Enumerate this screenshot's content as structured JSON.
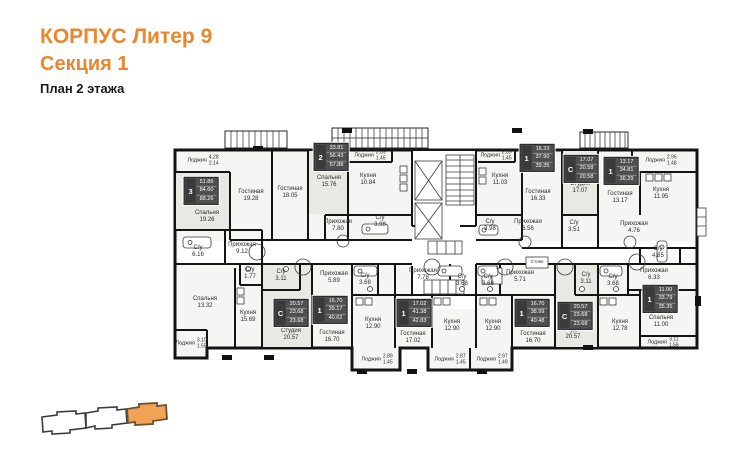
{
  "header": {
    "building": "КОРПУС Литер 9",
    "section": "Секция 1",
    "floor": "План 2 этажа"
  },
  "colors": {
    "accent": "#E8872E",
    "wall": "#141414",
    "keyplan_fill": "#F0A355",
    "keyplan_stroke": "#6B5134",
    "statbox_bg": "#4F4F4F",
    "statbox_type_bg": "#3A3A3A"
  },
  "plan": {
    "rooms": [
      {
        "name": "Лоджия",
        "a1": "4.28",
        "a2": "2.14",
        "x": 203,
        "y": 161
      },
      {
        "name": "Спальня",
        "area": "19.26",
        "x": 207,
        "y": 217
      },
      {
        "name": "Гостиная",
        "area": "19.28",
        "x": 251,
        "y": 196
      },
      {
        "name": "Гостиная",
        "area": "18.05",
        "x": 290,
        "y": 193
      },
      {
        "name": "Спальня",
        "area": "15.76",
        "x": 329,
        "y": 182
      },
      {
        "name": "Прихожая",
        "area": "7.80",
        "x": 338,
        "y": 226
      },
      {
        "name": "Лоджия",
        "a1": "2.89",
        "a2": "1.45",
        "x": 370,
        "y": 156
      },
      {
        "name": "Кухня",
        "area": "10.84",
        "x": 368,
        "y": 180
      },
      {
        "name": "С/у",
        "area": "3.98",
        "x": 380,
        "y": 222
      },
      {
        "name": "Лоджия",
        "a1": "2.89",
        "a2": "1.45",
        "x": 496,
        "y": 156
      },
      {
        "name": "Кухня",
        "area": "11.03",
        "x": 500,
        "y": 180
      },
      {
        "name": "С/у",
        "area": "3.98",
        "x": 490,
        "y": 226
      },
      {
        "name": "Гостиная",
        "area": "16.33",
        "x": 538,
        "y": 196
      },
      {
        "name": "Прихожая",
        "area": "6.56",
        "x": 528,
        "y": 226
      },
      {
        "name": "Студия",
        "area": "17.07",
        "x": 580,
        "y": 188
      },
      {
        "name": "С/у",
        "area": "3.51",
        "x": 574,
        "y": 227
      },
      {
        "name": "Гостиная",
        "area": "13.17",
        "x": 620,
        "y": 198
      },
      {
        "name": "Кухня",
        "area": "11.95",
        "x": 661,
        "y": 194
      },
      {
        "name": "Лоджия",
        "a1": "2.96",
        "a2": "1.48",
        "x": 661,
        "y": 161
      },
      {
        "name": "Прихожая",
        "area": "4.76",
        "x": 634,
        "y": 228
      },
      {
        "name": "С/у",
        "area": "6.16",
        "x": 198,
        "y": 252
      },
      {
        "name": "Прихожая",
        "area": "9.12",
        "x": 242,
        "y": 249
      },
      {
        "name": "С/у",
        "area": "1.77",
        "x": 250,
        "y": 274
      },
      {
        "name": "С/у",
        "area": "3.11",
        "x": 281,
        "y": 276
      },
      {
        "name": "Спальня",
        "area": "13.32",
        "x": 205,
        "y": 303
      },
      {
        "name": "Кухня",
        "area": "15.69",
        "x": 248,
        "y": 317
      },
      {
        "name": "Лоджия",
        "a1": "3.10",
        "a2": "1.55",
        "x": 191,
        "y": 344
      },
      {
        "name": "Студия",
        "area": "20.57",
        "x": 291,
        "y": 335
      },
      {
        "name": "Прихожая",
        "area": "5.89",
        "x": 334,
        "y": 278
      },
      {
        "name": "Гостиная",
        "area": "16.70",
        "x": 332,
        "y": 337
      },
      {
        "name": "С/у",
        "area": "3.68",
        "x": 365,
        "y": 280
      },
      {
        "name": "Кухня",
        "area": "12.90",
        "x": 373,
        "y": 324
      },
      {
        "name": "Прихожая",
        "area": "7.78",
        "x": 423,
        "y": 275
      },
      {
        "name": "Гостиная",
        "area": "17.02",
        "x": 413,
        "y": 338
      },
      {
        "name": "С/у",
        "area": "3.68",
        "x": 462,
        "y": 281
      },
      {
        "name": "Кухня",
        "area": "12.90",
        "x": 452,
        "y": 326
      },
      {
        "name": "С/у",
        "area": "3.68",
        "x": 488,
        "y": 281
      },
      {
        "name": "Кухня",
        "area": "12.90",
        "x": 493,
        "y": 326
      },
      {
        "name": "Прихожая",
        "area": "5.71",
        "x": 520,
        "y": 277
      },
      {
        "name": "Стояк",
        "x": 537,
        "y": 263
      },
      {
        "name": "Гостиная",
        "area": "16.70",
        "x": 533,
        "y": 338
      },
      {
        "name": "С/у",
        "area": "3.11",
        "x": 586,
        "y": 279
      },
      {
        "name": "Студия",
        "area": "20.57",
        "x": 573,
        "y": 334
      },
      {
        "name": "С/у",
        "area": "3.68",
        "x": 613,
        "y": 281
      },
      {
        "name": "Кухня",
        "area": "12.78",
        "x": 620,
        "y": 326
      },
      {
        "name": "С/у",
        "area": "4.85",
        "x": 658,
        "y": 253
      },
      {
        "name": "Прихожая",
        "area": "6.33",
        "x": 654,
        "y": 275
      },
      {
        "name": "Спальня",
        "area": "11.00",
        "x": 661,
        "y": 322
      },
      {
        "name": "Лоджия",
        "a1": "3.11",
        "a2": "1.56",
        "x": 663,
        "y": 343
      },
      {
        "name": "Лоджия",
        "a1": "2.89",
        "a2": "1.45",
        "x": 377,
        "y": 360
      },
      {
        "name": "Лоджия",
        "a1": "2.87",
        "a2": "1.45",
        "x": 450,
        "y": 360
      },
      {
        "name": "Лоджия",
        "a1": "2.97",
        "a2": "1.49",
        "x": 492,
        "y": 360
      }
    ],
    "apartments": [
      {
        "type": "3",
        "values": [
          "51.86",
          "84.60",
          "88.26"
        ],
        "x": 201,
        "y": 191
      },
      {
        "type": "2",
        "values": [
          "33.81",
          "56.43",
          "57.88"
        ],
        "x": 331,
        "y": 157
      },
      {
        "type": "1",
        "values": [
          "16.33",
          "37.90",
          "39.35"
        ],
        "x": 537,
        "y": 158
      },
      {
        "type": "С",
        "values": [
          "17.07",
          "20.58",
          "20.58"
        ],
        "x": 581,
        "y": 169
      },
      {
        "type": "1",
        "values": [
          "13.17",
          "34.81",
          "36.29"
        ],
        "x": 621,
        "y": 171
      },
      {
        "type": "С",
        "values": [
          "20.57",
          "23.68",
          "23.68"
        ],
        "x": 291,
        "y": 313
      },
      {
        "type": "1",
        "values": [
          "16.70",
          "39.17",
          "40.62"
        ],
        "x": 330,
        "y": 310
      },
      {
        "type": "1",
        "values": [
          "17.02",
          "41.38",
          "42.83"
        ],
        "x": 414,
        "y": 313
      },
      {
        "type": "1",
        "values": [
          "16.70",
          "38.99",
          "40.48"
        ],
        "x": 532,
        "y": 313
      },
      {
        "type": "С",
        "values": [
          "20.57",
          "23.68",
          "23.68"
        ],
        "x": 575,
        "y": 316
      },
      {
        "type": "1",
        "values": [
          "11.00",
          "33.79",
          "35.35"
        ],
        "x": 660,
        "y": 299
      }
    ]
  }
}
